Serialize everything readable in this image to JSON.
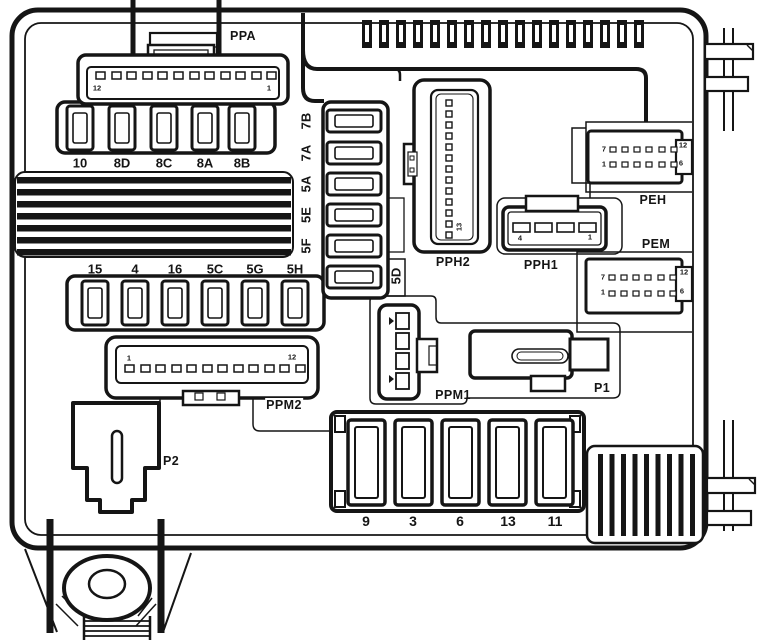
{
  "labels": {
    "ppa": "PPA",
    "pph2": "PPH2",
    "pph1": "PPH1",
    "peh": "PEH",
    "pem": "PEM",
    "ppm1": "PPM1",
    "ppm2": "PPM2",
    "p1": "P1",
    "p2": "P2"
  },
  "fuses": {
    "row_top": [
      "10",
      "8D",
      "8C",
      "8A",
      "8B"
    ],
    "row_mid": [
      "15",
      "4",
      "16",
      "5C",
      "5G",
      "5H"
    ],
    "column": [
      "7B",
      "7A",
      "5A",
      "5E",
      "5F"
    ],
    "column_side": "5D",
    "row_bottom": [
      "9",
      "3",
      "6",
      "13",
      "11"
    ]
  },
  "pin_numbers": {
    "ppa": {
      "left": "12",
      "right": "1"
    },
    "ppm2": {
      "left": "1",
      "right": "12"
    },
    "pph1": {
      "left": "4",
      "right": "1"
    },
    "pph2": {
      "bottom": "13"
    },
    "peh": {
      "top_left": "7",
      "top_right": "12",
      "bottom_left": "1",
      "bottom_right": "6"
    },
    "pem": {
      "top_left": "7",
      "top_right": "12",
      "bottom_left": "1",
      "bottom_right": "6"
    }
  },
  "colors": {
    "line": "#151515",
    "background": "#ffffff"
  }
}
